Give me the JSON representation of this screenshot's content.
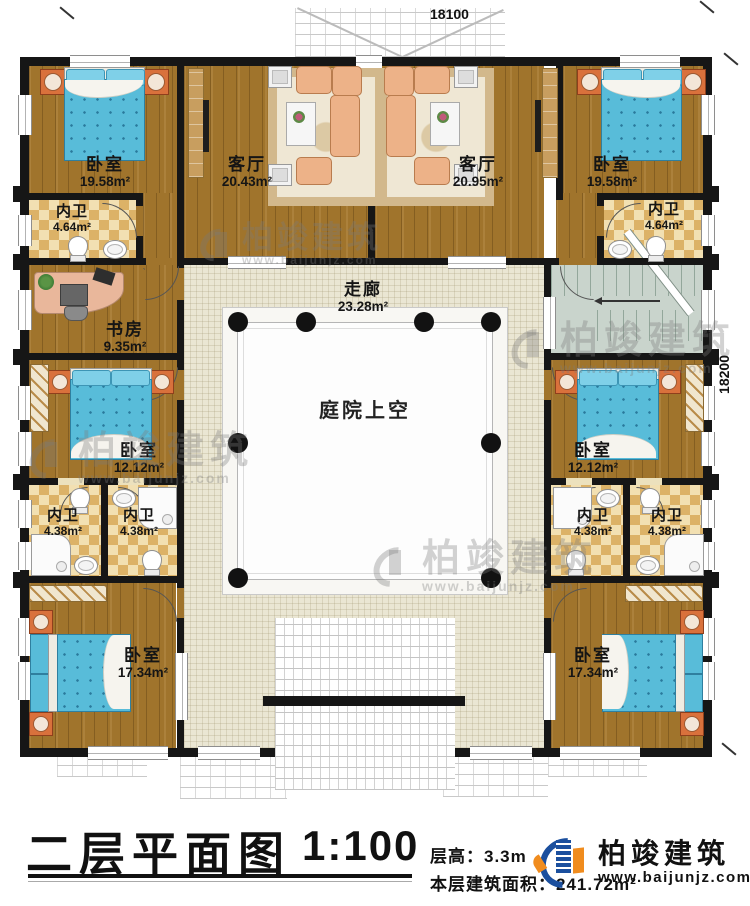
{
  "dimensions": {
    "top": "18100",
    "right": "18200"
  },
  "rooms": {
    "bedroom_tl": {
      "name": "卧室",
      "area": "19.58m²"
    },
    "living_left": {
      "name": "客厅",
      "area": "20.43m²"
    },
    "living_right": {
      "name": "客厅",
      "area": "20.95m²"
    },
    "bedroom_tr": {
      "name": "卧室",
      "area": "19.58m²"
    },
    "bath_tl": {
      "name": "内卫",
      "area": "4.64m²"
    },
    "bath_tr": {
      "name": "内卫",
      "area": "4.64m²"
    },
    "study": {
      "name": "书房",
      "area": "9.35m²"
    },
    "corridor": {
      "name": "走廊",
      "area": "23.28m²"
    },
    "courtyard": {
      "name": "庭院上空"
    },
    "bedroom_ml": {
      "name": "卧室",
      "area": "12.12m²"
    },
    "bedroom_mr": {
      "name": "卧室",
      "area": "12.12m²"
    },
    "bath_ml_a": {
      "name": "内卫",
      "area": "4.38m²"
    },
    "bath_ml_b": {
      "name": "内卫",
      "area": "4.38m²"
    },
    "bath_mr_a": {
      "name": "内卫",
      "area": "4.38m²"
    },
    "bath_mr_b": {
      "name": "内卫",
      "area": "4.38m²"
    },
    "bedroom_bl": {
      "name": "卧室",
      "area": "17.34m²"
    },
    "bedroom_br": {
      "name": "卧室",
      "area": "17.34m²"
    }
  },
  "title_block": {
    "title": "二层平面图",
    "scale": "1:100",
    "floor_height": "层高：3.3m",
    "floor_area": "本层建筑面积：241.72m²"
  },
  "brand": {
    "name": "柏竣建筑",
    "website": "www.baijunjz.com"
  },
  "watermark": {
    "name": "柏竣建筑",
    "website": "www.baijunjz.com"
  },
  "colors": {
    "wall": "#161616",
    "wood_floor": "#a0742c",
    "bath_tile": "#dcb267",
    "corridor_tile": "#eae6d3",
    "mattress_blue": "#58bcd9",
    "brand_blue": "#1b4f9e",
    "brand_orange": "#f08c1e"
  }
}
